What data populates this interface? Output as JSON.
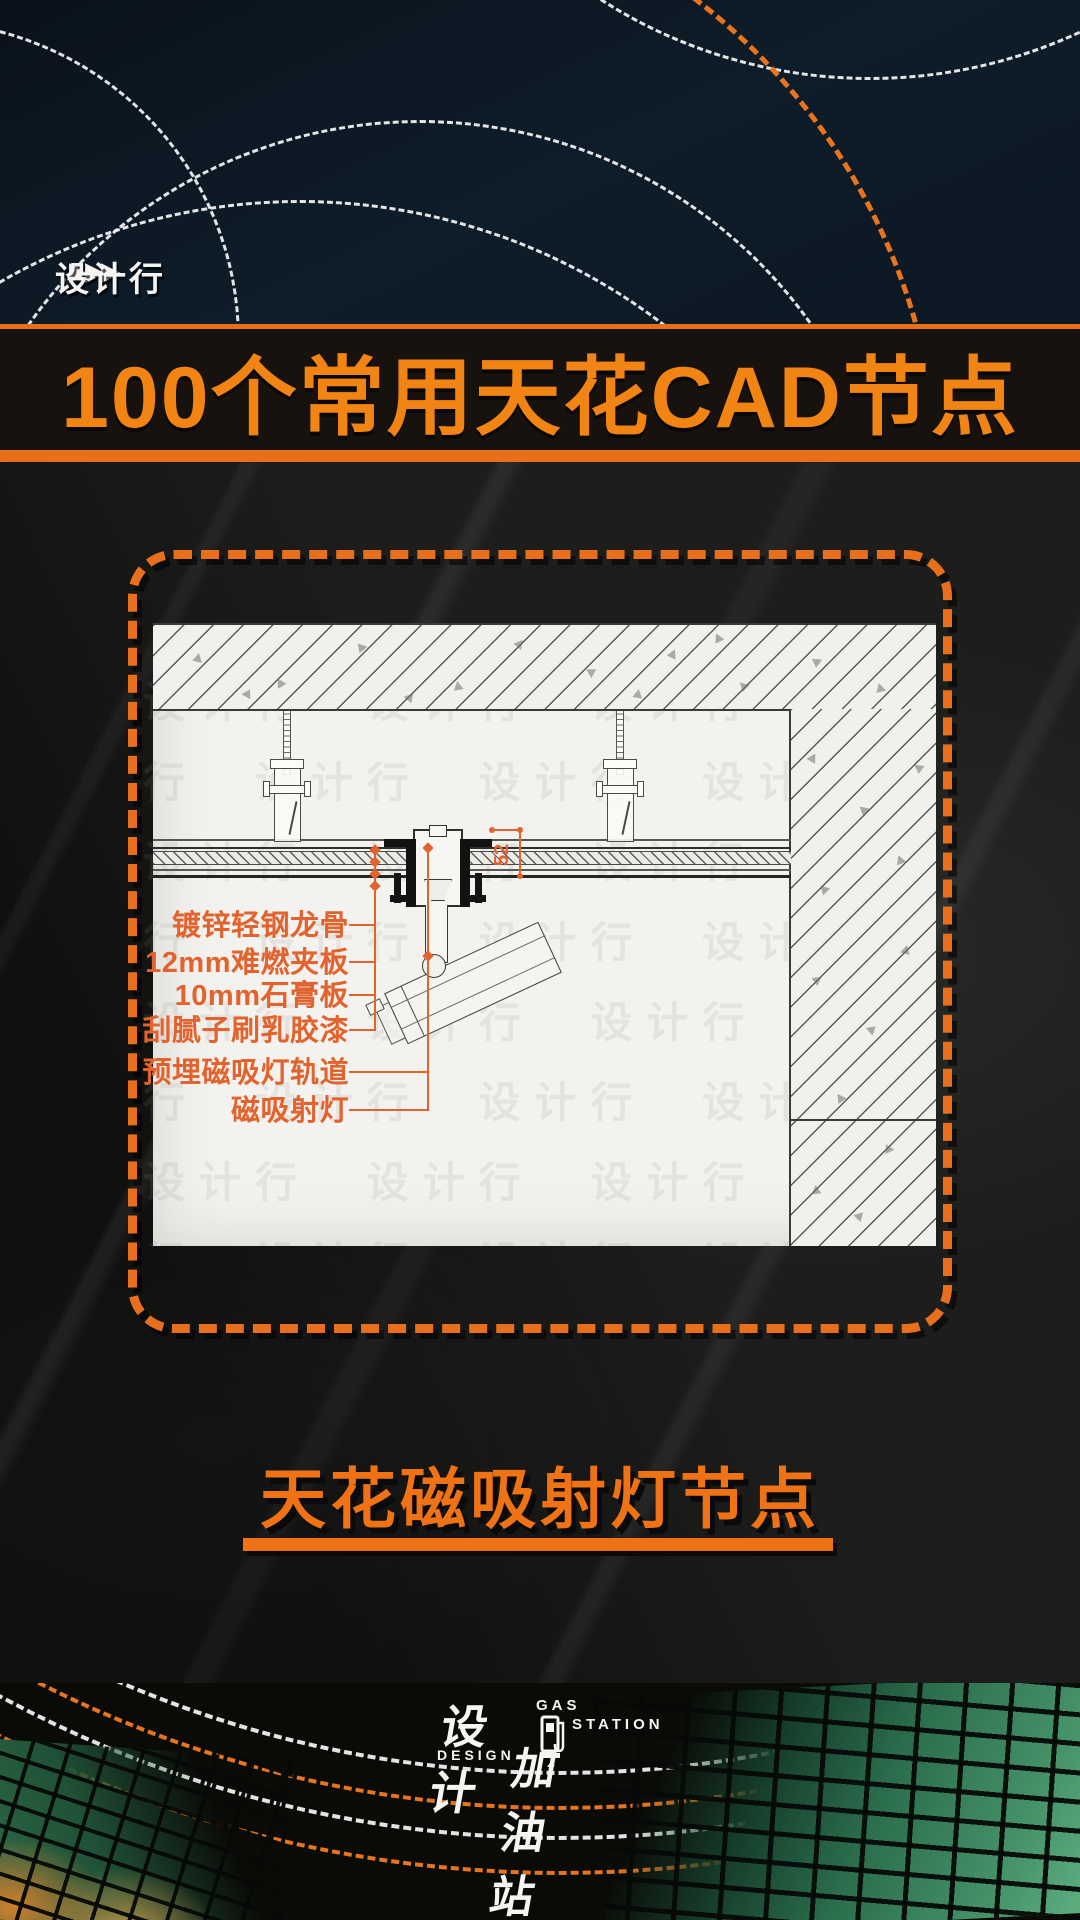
{
  "poster": {
    "brand": "设计行",
    "brand_arrows": "▶▶▶",
    "title": "100个常用天花CAD节点",
    "caption": "天花磁吸射灯节点"
  },
  "diagram": {
    "labels": [
      "镀锌轻钢龙骨",
      "12mm难燃夹板",
      "10mm石膏板",
      "刮腻子刷乳胶漆",
      "预埋磁吸灯轨道",
      "磁吸射灯"
    ],
    "dimension": "52",
    "watermark": {
      "text": "设计行",
      "repeat": 96
    }
  },
  "footer": {
    "logo": {
      "cn_top": "设计",
      "cn_bottom": "加油站",
      "en_gas": "GAS",
      "en_station": "STATION",
      "en_design": "DESIGN"
    }
  },
  "colors": {
    "accent_orange": "#e8701d",
    "title_orange": "#f28414",
    "label_orange": "#e2632e",
    "panel_white": "#f3f2ee",
    "top_navy": "#0e1d2a",
    "stone_dark": "#1d1d1c",
    "mosaic_green": "#459168",
    "mosaic_orange": "#d07f2c"
  }
}
